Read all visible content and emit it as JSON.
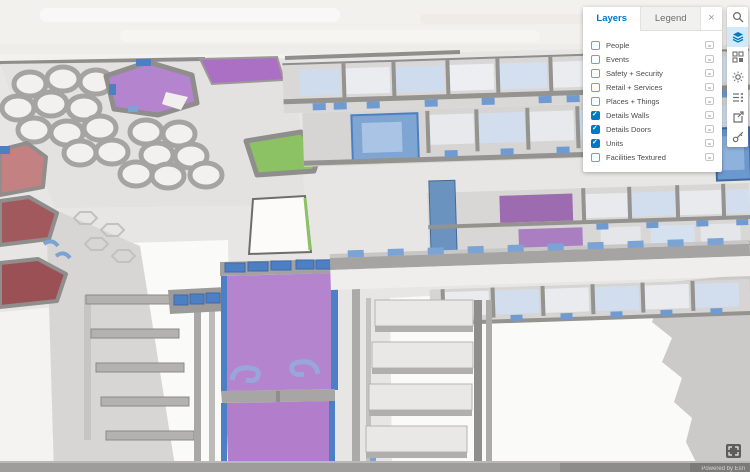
{
  "panel": {
    "tabs": [
      {
        "label": "Layers",
        "active": true
      },
      {
        "label": "Legend",
        "active": false
      }
    ],
    "close_glyph": "×",
    "layers": [
      {
        "label": "People",
        "checked": false
      },
      {
        "label": "Events",
        "checked": false
      },
      {
        "label": "Safety + Security",
        "checked": false
      },
      {
        "label": "Retail + Services",
        "checked": false
      },
      {
        "label": "Places + Things",
        "checked": false
      },
      {
        "label": "Details Walls",
        "checked": true
      },
      {
        "label": "Details Doors",
        "checked": true
      },
      {
        "label": "Units",
        "checked": true
      },
      {
        "label": "Facilities Textured",
        "checked": false
      }
    ]
  },
  "toolbar": {
    "buttons": [
      {
        "name": "search",
        "active": false
      },
      {
        "name": "layers",
        "active": true
      },
      {
        "name": "basemap",
        "active": false
      },
      {
        "name": "daylight",
        "active": false
      },
      {
        "name": "levels",
        "active": false
      },
      {
        "name": "share",
        "active": false
      },
      {
        "name": "tools",
        "active": false
      }
    ]
  },
  "map": {
    "attribution": "Powered by Esri"
  },
  "colors": {
    "accent": "#0079C1",
    "unit_purple": "#B584CF",
    "unit_purple_dark": "#9C6BB0",
    "unit_green": "#8CC263",
    "unit_red": "#C48182",
    "unit_maroon": "#9E565C",
    "door_blue": "#4D7FC4",
    "door_blue_light": "#7BA3D4",
    "wall_gray": "#94938F",
    "floor_gray": "#E7E6E4",
    "sky": "#F3F1ED"
  }
}
